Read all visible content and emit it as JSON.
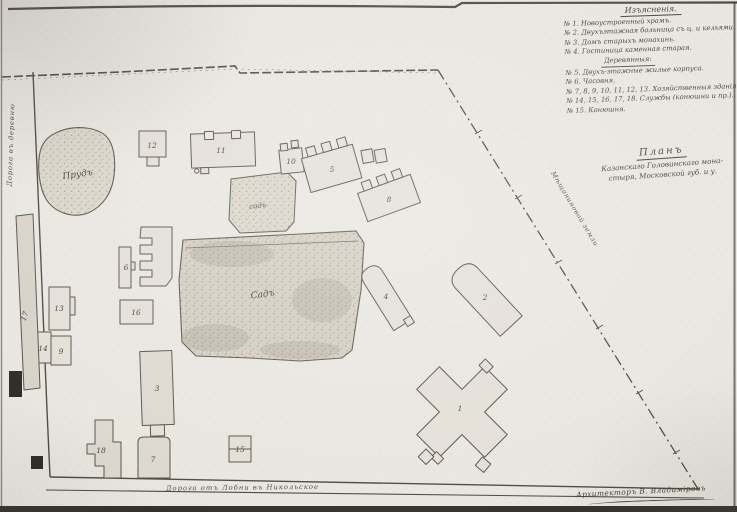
{
  "plan": {
    "legend": {
      "heading": "Изъясненія.",
      "lines": [
        "№ 1. Новоустроенный храмъ.",
        "№ 2. Двухъэтажная больница съ ц. и кельями.",
        "№ 3. Домъ старыхъ монахинь.",
        "№ 4. Гостиница каменная старая.",
        "Деревянныя:",
        "№ 5. Двухъ-этажные жилые корпуса.",
        "№ 6. Часовня.",
        "№ 7, 8, 9, 10, 11, 12, 13. Хозяйственныя зданія.",
        "№ 14, 15, 16, 17, 18. Службы (конюшни и пр.).",
        "№ 15. Конюшня."
      ]
    },
    "title": {
      "heading": "Планъ",
      "line1": "Казанскаго Головинскаго мона-",
      "line2": "стыря, Московской губ. и у."
    },
    "labels": {
      "left_road": "Дорога въ деревню",
      "bottom_road": "Дорога отъ Лобни въ Никольское",
      "adjacent_land": "Мѣщаниновой земли",
      "signature": "Архитекторъ В. Владиміровъ",
      "pond": "Прудъ",
      "garden_large": "Садъ",
      "garden_small": "садъ"
    },
    "buildings": [
      {
        "num": "1"
      },
      {
        "num": "2"
      },
      {
        "num": "3"
      },
      {
        "num": "4"
      },
      {
        "num": "5"
      },
      {
        "num": "6"
      },
      {
        "num": "7"
      },
      {
        "num": "8"
      },
      {
        "num": "9"
      },
      {
        "num": "10"
      },
      {
        "num": "11"
      },
      {
        "num": "12"
      },
      {
        "num": "13"
      },
      {
        "num": "14"
      },
      {
        "num": "15"
      },
      {
        "num": "16"
      },
      {
        "num": "17"
      },
      {
        "num": "18"
      }
    ],
    "ink_color": "#4e4942",
    "building_fill": "#e3dfd7"
  }
}
